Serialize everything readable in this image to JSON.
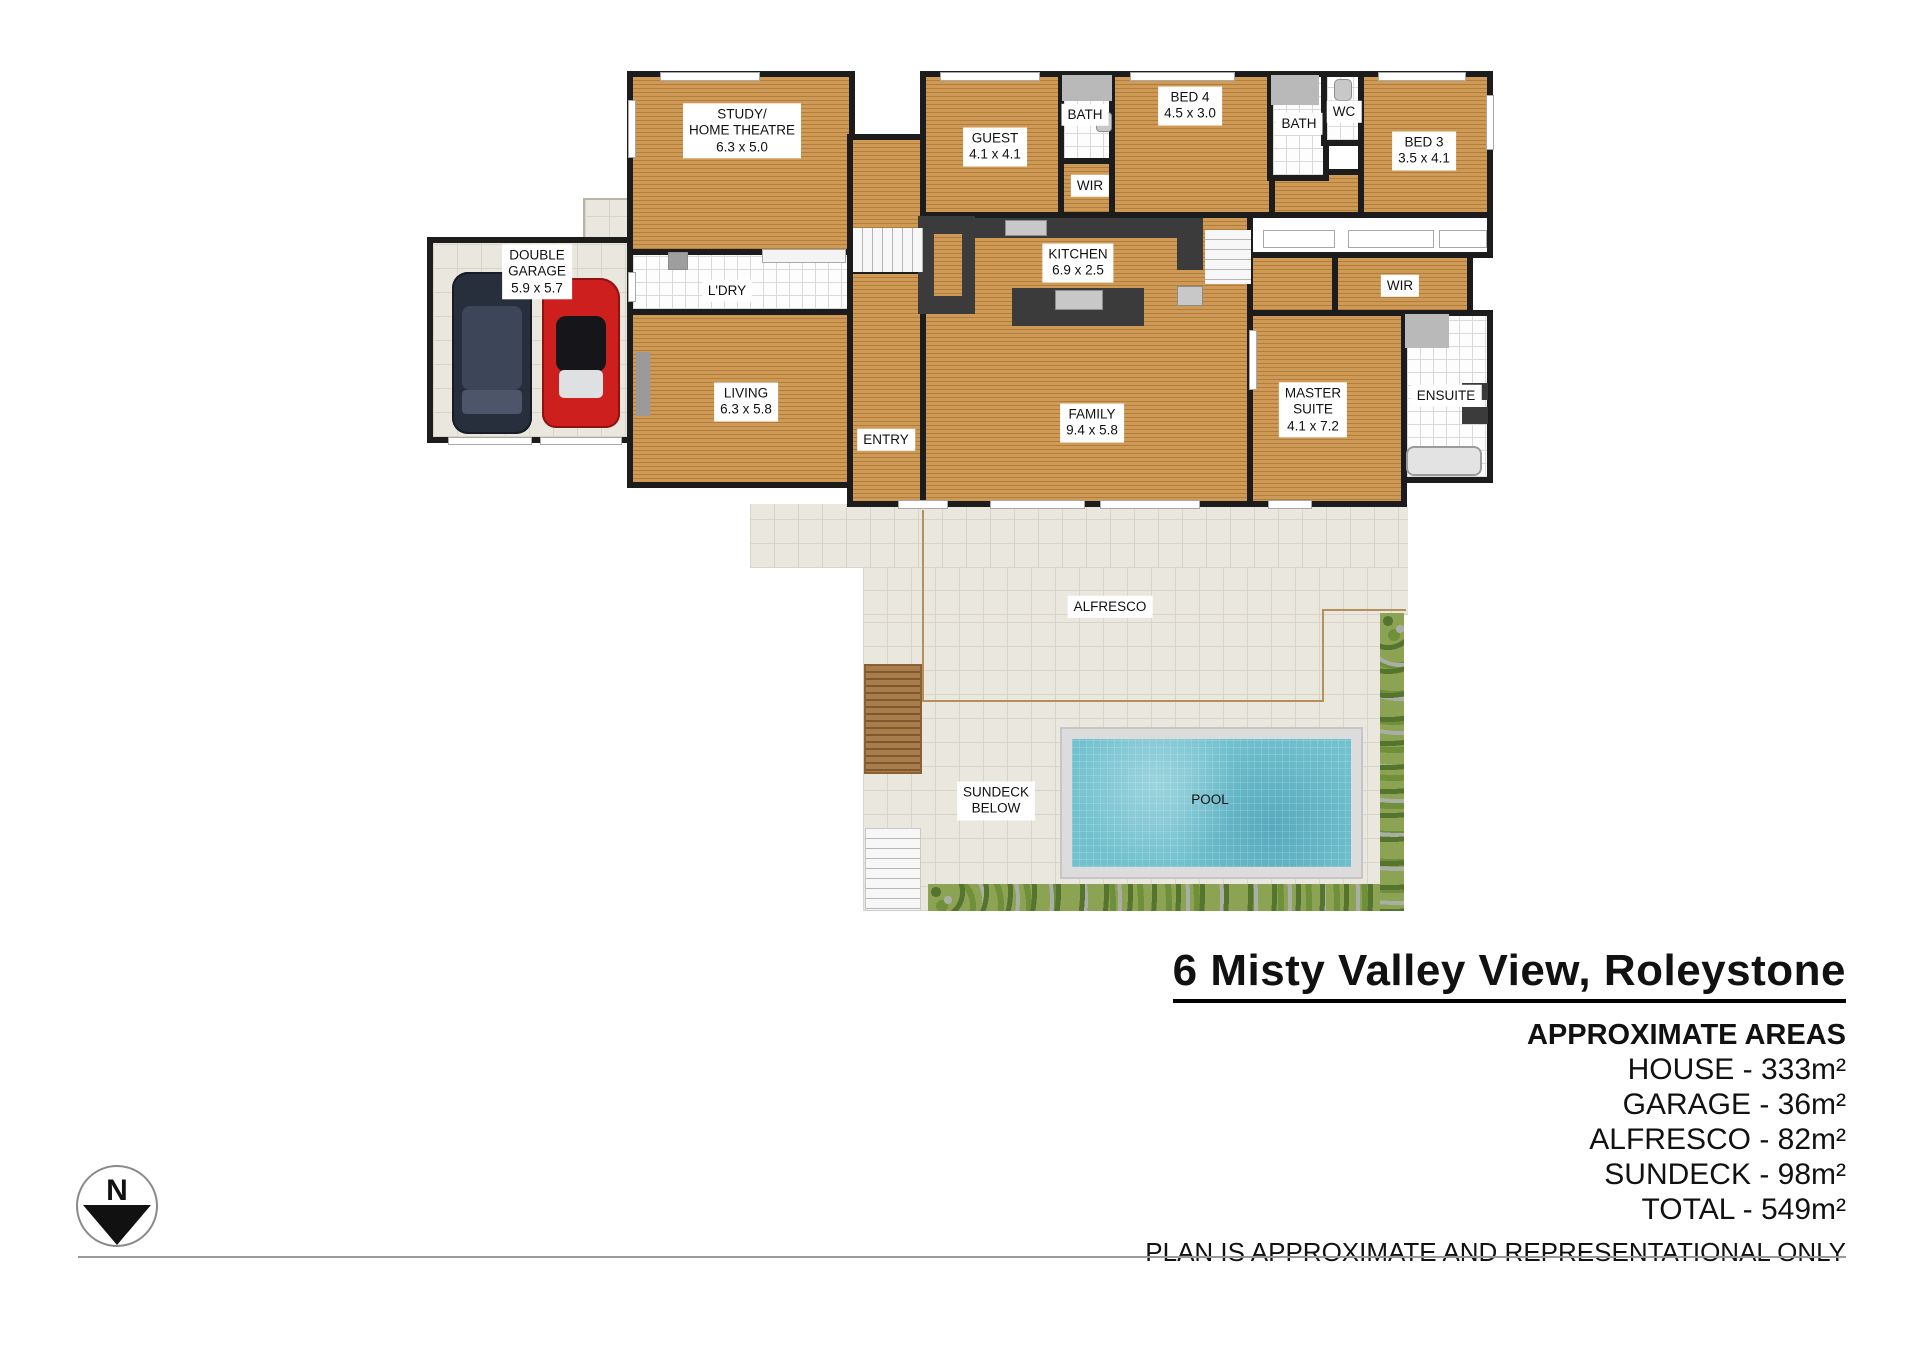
{
  "rooms": {
    "study": {
      "lines": [
        "STUDY/",
        "HOME THEATRE",
        "6.3 x 5.0"
      ]
    },
    "garage": {
      "lines": [
        "DOUBLE",
        "GARAGE",
        "5.9 x 5.7"
      ]
    },
    "ldry": {
      "lines": [
        "L'DRY"
      ]
    },
    "living": {
      "lines": [
        "LIVING",
        "6.3 x 5.8"
      ]
    },
    "entry": {
      "lines": [
        "ENTRY"
      ]
    },
    "guest": {
      "lines": [
        "GUEST",
        "4.1 x 4.1"
      ]
    },
    "bath1": {
      "lines": [
        "BATH"
      ]
    },
    "wir1": {
      "lines": [
        "WIR"
      ]
    },
    "bed4": {
      "lines": [
        "BED 4",
        "4.5 x 3.0"
      ]
    },
    "bath2": {
      "lines": [
        "BATH"
      ]
    },
    "wc": {
      "lines": [
        "WC"
      ]
    },
    "bed3": {
      "lines": [
        "BED 3",
        "3.5 x 4.1"
      ]
    },
    "kitchen": {
      "lines": [
        "KITCHEN",
        "6.9 x 2.5"
      ]
    },
    "family": {
      "lines": [
        "FAMILY",
        "9.4 x 5.8"
      ]
    },
    "wir2": {
      "lines": [
        "WIR"
      ]
    },
    "master": {
      "lines": [
        "MASTER",
        "SUITE",
        "4.1 x 7.2"
      ]
    },
    "ensuite": {
      "lines": [
        "ENSUITE"
      ]
    },
    "alfresco": {
      "lines": [
        "ALFRESCO"
      ]
    },
    "sundeck": {
      "lines": [
        "SUNDECK",
        "BELOW"
      ]
    },
    "pool": {
      "lines": [
        "POOL"
      ]
    }
  },
  "title_block": {
    "address": "6 Misty Valley View, Roleystone",
    "areas_heading": "APPROXIMATE AREAS",
    "areas": [
      "HOUSE - 333m²",
      "GARAGE - 36m²",
      "ALFRESCO - 82m²",
      "SUNDECK - 98m²",
      "TOTAL - 549m²"
    ],
    "disclaimer": "PLAN IS APPROXIMATE AND REPRESENTATIONAL ONLY"
  },
  "compass": {
    "label": "N"
  },
  "colors": {
    "wood_floor": "#cf9a55",
    "wall": "#1c1c1c",
    "kitchen_bench": "#3b3b3b",
    "paving": "#eae7df",
    "pool_water": "#72c1cf",
    "greenery": "#8ba352",
    "deck_timber": "#a97c4b",
    "suv_car": "#272e3c",
    "sports_car": "#ce1f1f"
  }
}
